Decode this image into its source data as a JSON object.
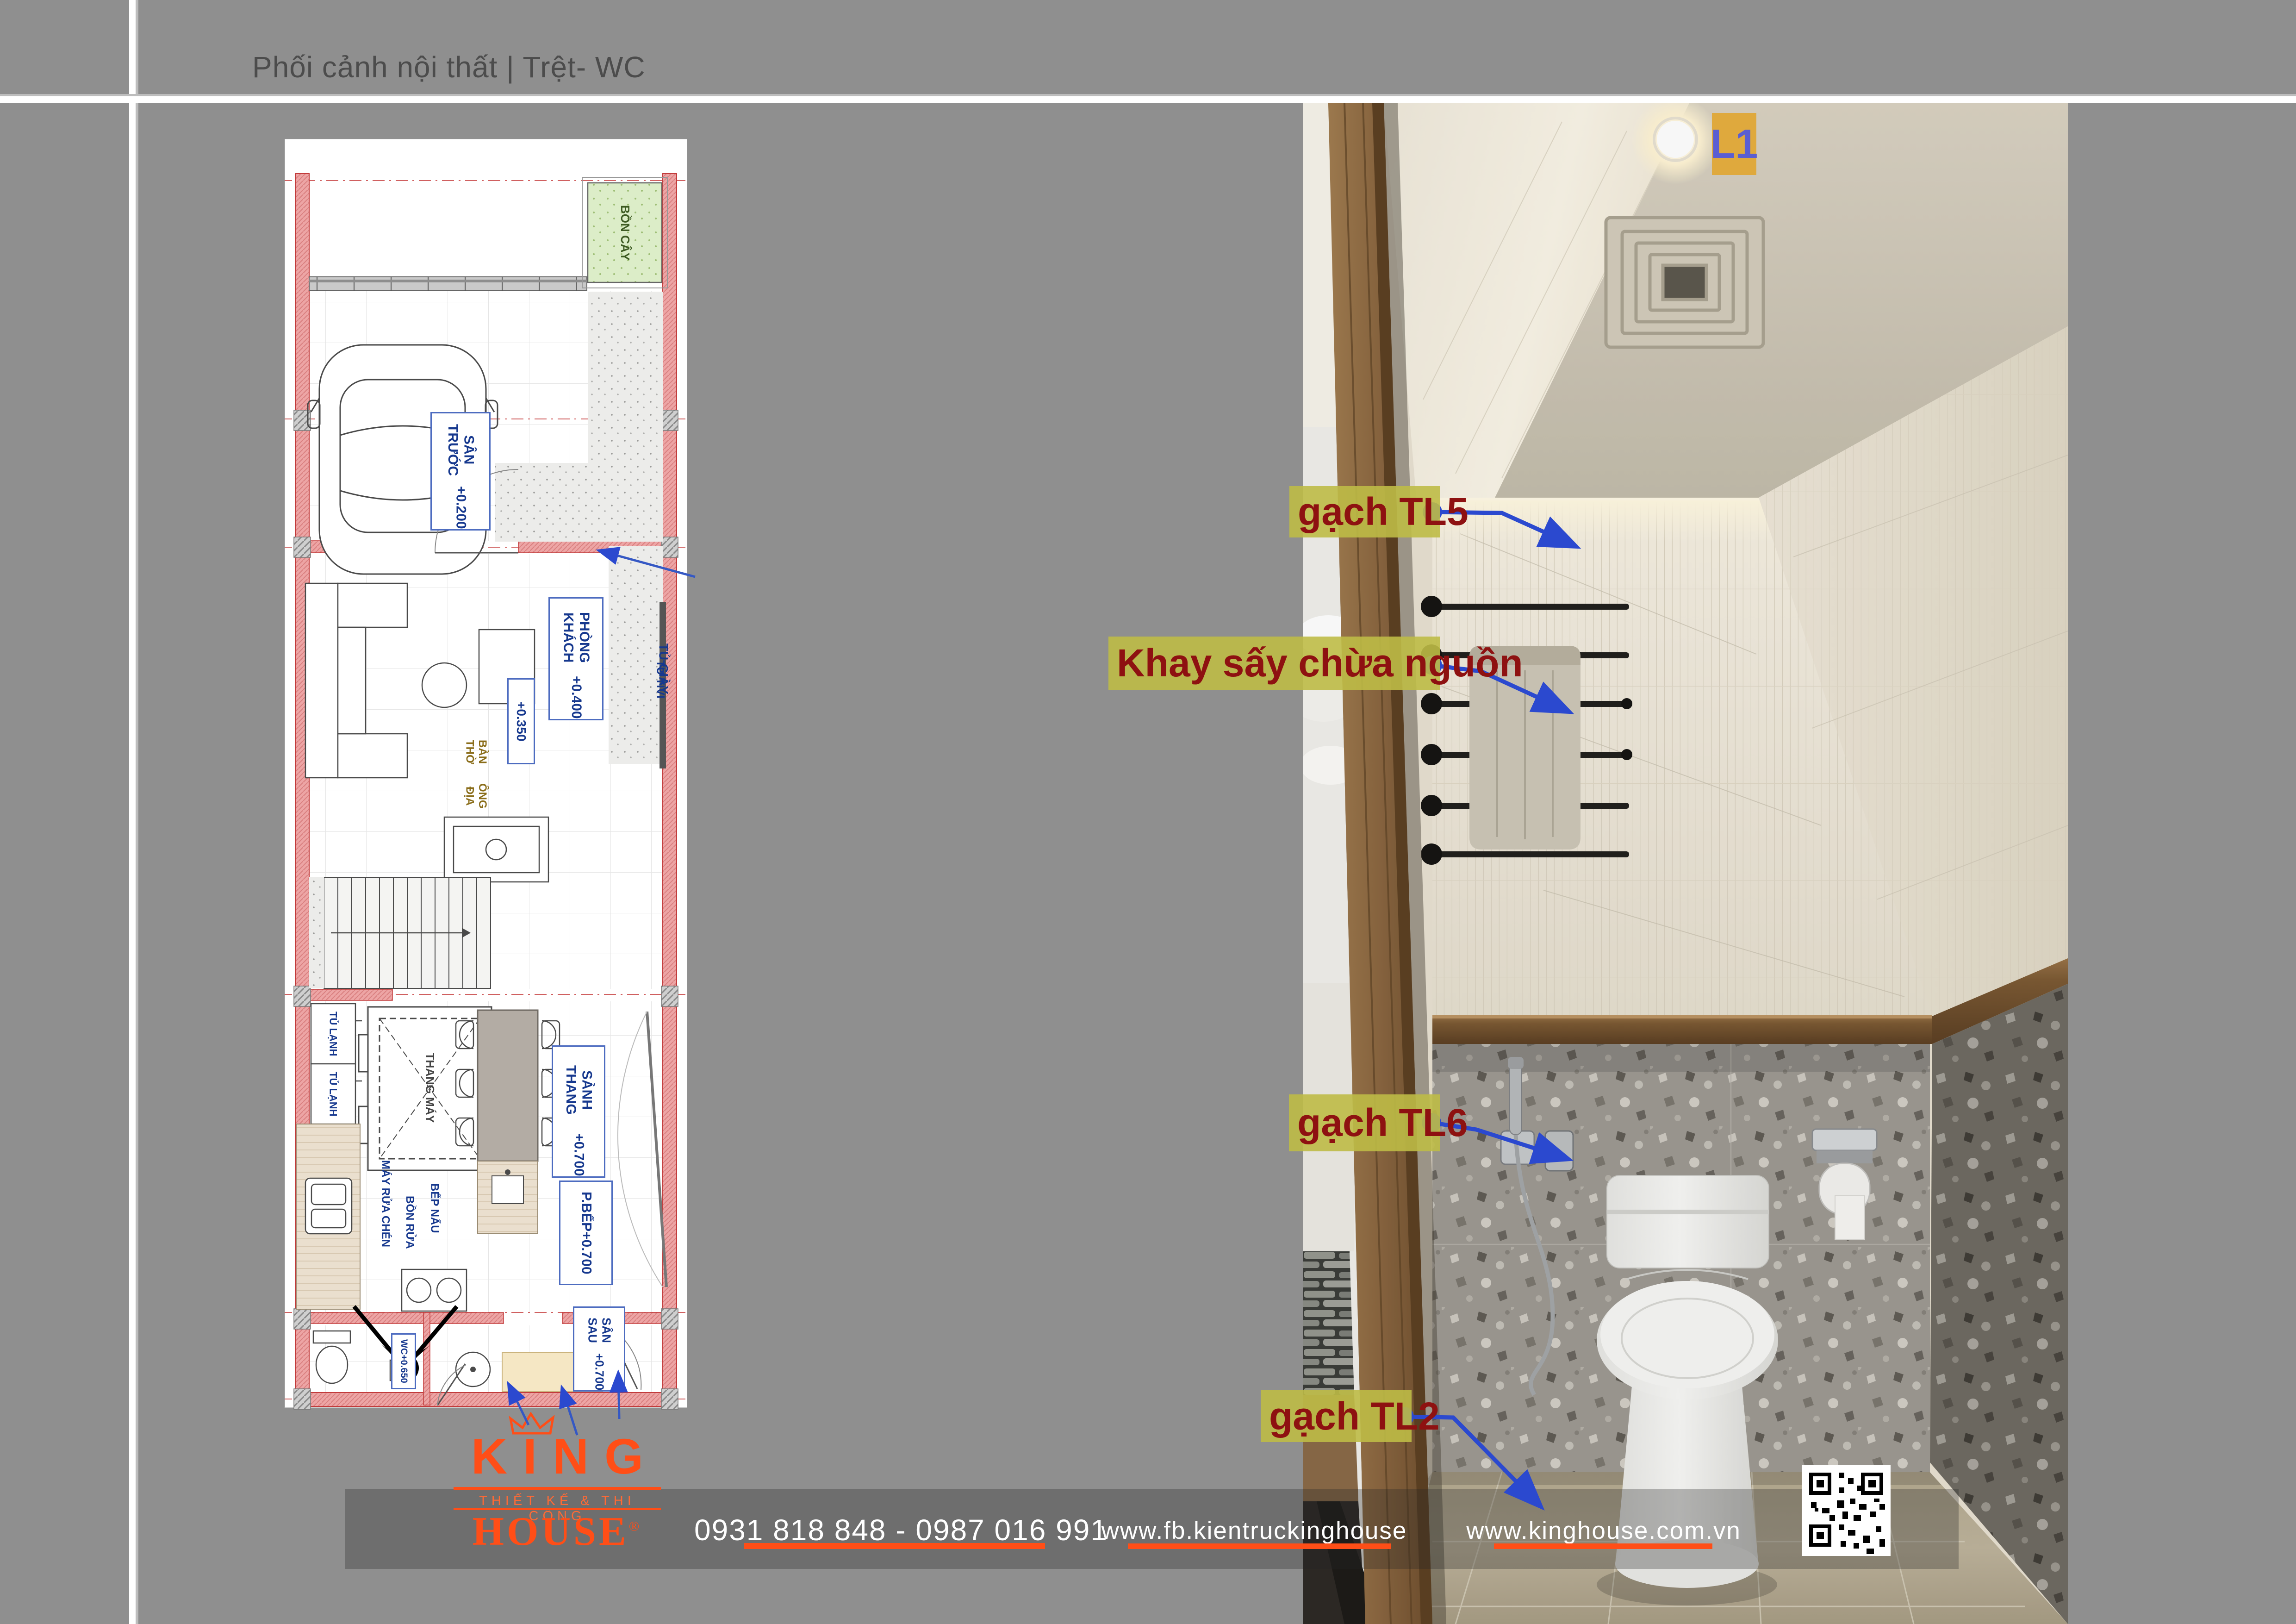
{
  "page": {
    "title": "Phối cảnh nội thất | Trệt- WC"
  },
  "plan": {
    "rooms": {
      "san_truoc": {
        "name": "SÂN TRƯỚC",
        "level": "+0.200"
      },
      "level_0350": {
        "level": "+0.350"
      },
      "phong_khach": {
        "name": "PHÒNG KHÁCH",
        "level": "+0.400"
      },
      "sanh_thang": {
        "name": "SẢNH THANG",
        "level": "+0.700"
      },
      "p_bep": {
        "name": "P.BẾP",
        "level": "+0.700"
      },
      "wc": {
        "name": "WC",
        "level": "+0.650"
      },
      "san_sau": {
        "name": "SÂN SAU",
        "level": "+0.700"
      }
    },
    "items": {
      "bon_cay": "BỒN CÂY",
      "tu_giay": "TỦ GIÀY",
      "tu_tivi": "TỦ TIVI",
      "ban_tho_1": "BÀN THỜ",
      "ban_tho_2": "ÔNG ĐỊA",
      "thang_may": "THANG MÁY",
      "tu_lanh": "TỦ LẠNH",
      "may_rua_chen": "MÁY RỬA CHÉN",
      "bon_rua": "BỒN RỬA",
      "bep_nau": "BẾP NẤU"
    }
  },
  "annotations": {
    "l1": "L1",
    "tl5": "gạch TL5",
    "khay_say": "Khay sấy chừa nguồn",
    "tl6": "gạch TL6",
    "tl2": "gạch TL2"
  },
  "footer": {
    "brand_top": "KING",
    "brand_tagline": "THIẾT KẾ & THI CÔNG",
    "brand_bottom": "HOUSE",
    "brand_reg": "®",
    "phone": "0931 818 848 - 0987 016 991",
    "facebook": "www.fb.kientruckinghouse",
    "website": "www.kinghouse.com.vn"
  },
  "colors": {
    "accent_orange": "#ff4e17",
    "leader_blue": "#2b49cf",
    "note_bg": "#bdba4e",
    "note_text": "#8e1111",
    "l1_bg": "#dfa93d",
    "l1_text": "#5a5ed2"
  }
}
